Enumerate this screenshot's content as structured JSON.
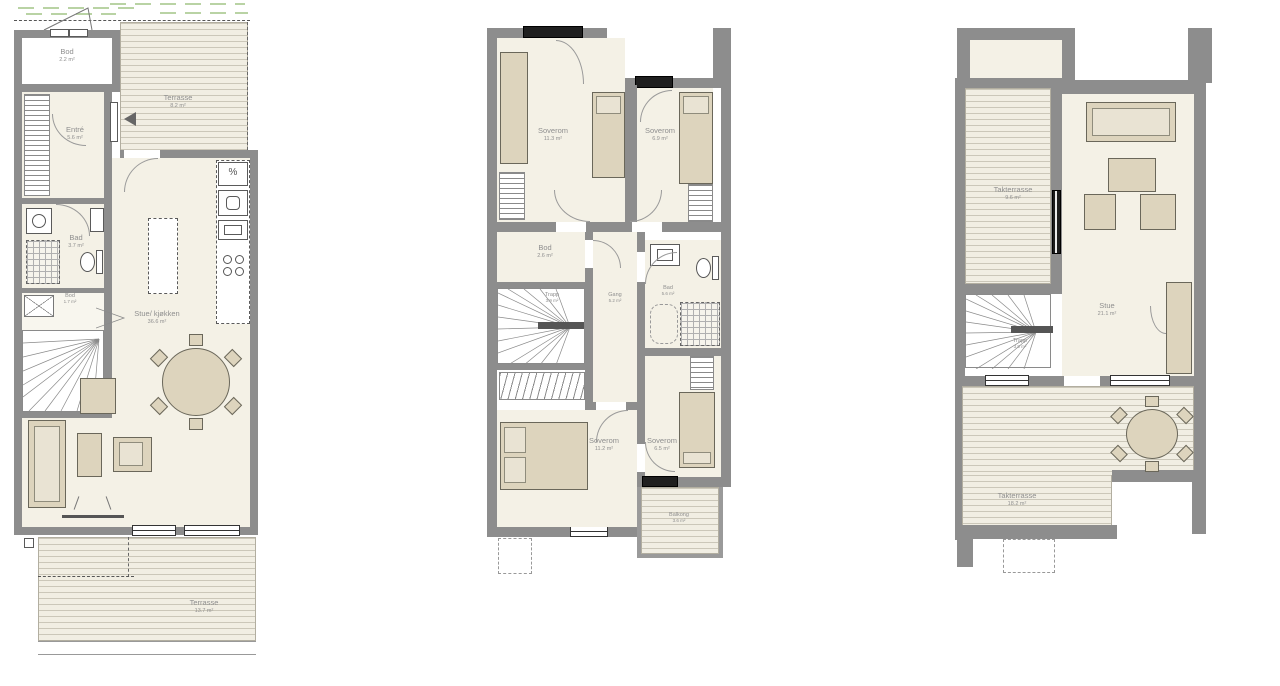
{
  "drawing_type": "floor-plans",
  "colors": {
    "wall": "#8d8d8d",
    "floor": "#f4f1e6",
    "furniture": "#ddd4bd",
    "deck_line": "#cbc7b9",
    "label": "#8f8f8f",
    "greenery": "#b9d3a4",
    "window_dark": "#1f1f1f"
  },
  "icons": {
    "dishwasher_glyph": "%"
  },
  "plans": [
    {
      "rooms": [
        {
          "name": "Bod",
          "area": "2.2 m²"
        },
        {
          "name": "Terrasse",
          "area": "8.2 m²"
        },
        {
          "name": "Entré",
          "area": "5.6 m²"
        },
        {
          "name": "Bad",
          "area": "3.7 m²"
        },
        {
          "name": "Bod",
          "area": "1.7 m²"
        },
        {
          "name": "Stue/ kjøkken",
          "area": "36.6 m²"
        },
        {
          "name": "Terrasse",
          "area": "13.7 m²"
        }
      ]
    },
    {
      "rooms": [
        {
          "name": "Soverom",
          "area": "11.3 m²"
        },
        {
          "name": "Soverom",
          "area": "6.9 m²"
        },
        {
          "name": "Bod",
          "area": "2.6 m²"
        },
        {
          "name": "Trapp",
          "area": "3.9 m²"
        },
        {
          "name": "Gang",
          "area": "5.2 m²"
        },
        {
          "name": "Bad",
          "area": "5.6 m²"
        },
        {
          "name": "Soverom",
          "area": "11.2 m²"
        },
        {
          "name": "Soverom",
          "area": "6.5 m²"
        },
        {
          "name": "Balkong",
          "area": "3.6 m²"
        }
      ]
    },
    {
      "rooms": [
        {
          "name": "Takterrasse",
          "area": "9.6 m²"
        },
        {
          "name": "Stue",
          "area": "21.1 m²"
        },
        {
          "name": "Trapp",
          "area": "3.9 m²"
        },
        {
          "name": "Takterrasse",
          "area": "18.2 m²"
        }
      ]
    }
  ]
}
